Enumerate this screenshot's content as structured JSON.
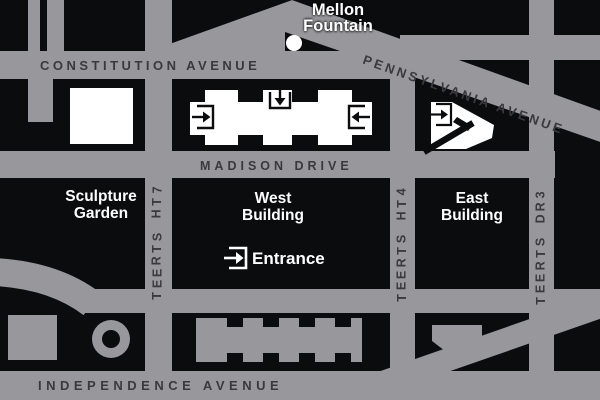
{
  "colors": {
    "road": "#98979b",
    "block": "#0b0c0e",
    "street_label": "#3a393d",
    "building_white": "#ffffff"
  },
  "streets": {
    "constitution": "CONSTITUTION AVENUE",
    "pennsylvania": "PENNSYLVANIA AVENUE",
    "madison": "MADISON DRIVE",
    "independence": "INDEPENDENCE AVENUE",
    "seventh": "7TH STREET",
    "fourth": "4TH STREET",
    "third": "3RD STREET"
  },
  "labels": {
    "mellon_line1": "Mellon",
    "mellon_line2": "Fountain",
    "sculpture_line1": "Sculpture",
    "sculpture_line2": "Garden",
    "west_line1": "West",
    "west_line2": "Building",
    "east_line1": "East",
    "east_line2": "Building",
    "entrance": "Entrance"
  }
}
